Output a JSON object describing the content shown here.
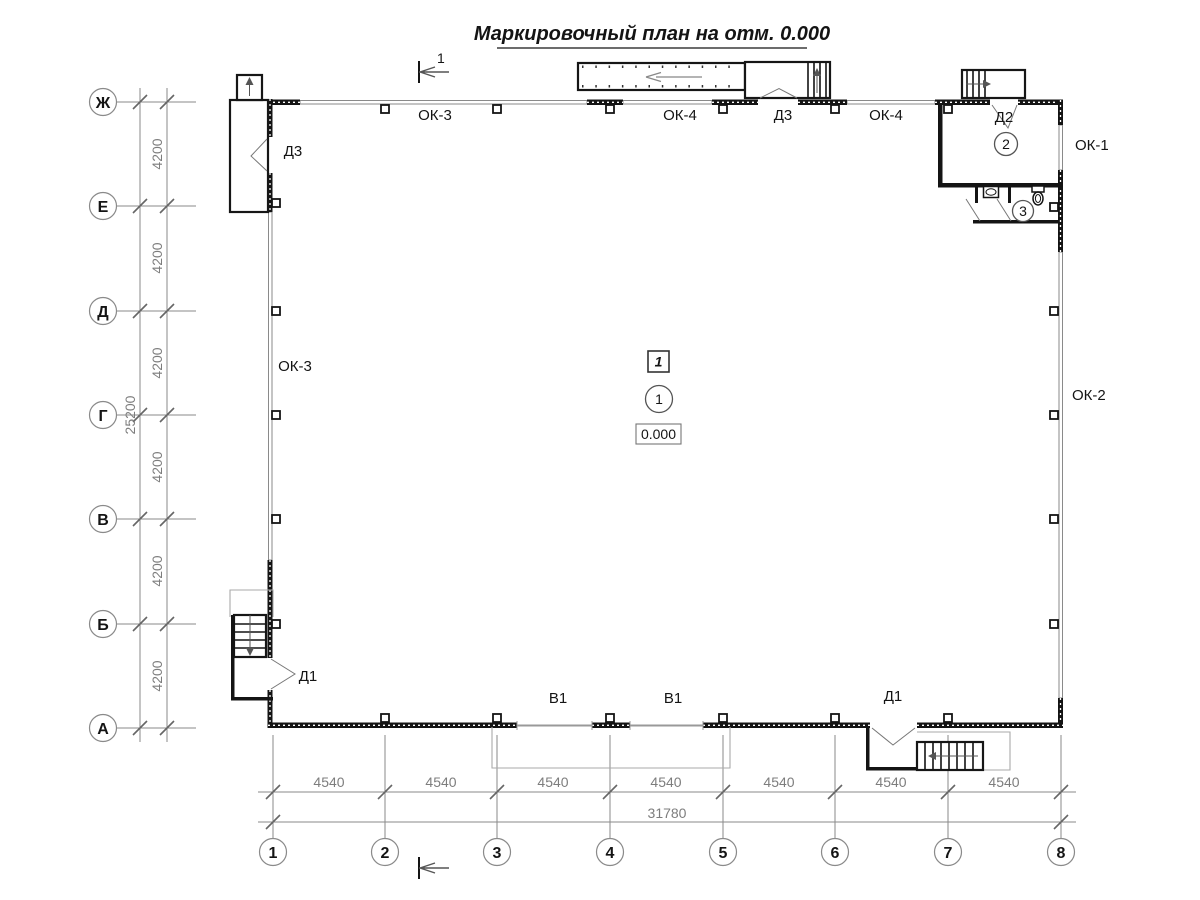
{
  "title": "Маркировочный план на отм. 0.000",
  "axes": {
    "rows": [
      "Ж",
      "Е",
      "Д",
      "Г",
      "В",
      "Б",
      "А"
    ],
    "cols": [
      "1",
      "2",
      "3",
      "4",
      "5",
      "6",
      "7",
      "8"
    ]
  },
  "dims": {
    "v_spans": [
      "4200",
      "4200",
      "4200",
      "4200",
      "4200",
      "4200"
    ],
    "v_total": "25200",
    "h_spans": [
      "4540",
      "4540",
      "4540",
      "4540",
      "4540",
      "4540",
      "4540"
    ],
    "h_total": "31780"
  },
  "labels": {
    "ok3_top": "ОК-3",
    "ok4_top_left": "ОК-4",
    "d3_top": "Д3",
    "ok4_top_right": "ОК-4",
    "d2": "Д2",
    "ok1": "ОК-1",
    "ok2": "ОК-2",
    "ok3_left": "ОК-3",
    "d3_left": "Д3",
    "d1_left": "Д1",
    "d1_right": "Д1",
    "v1_left": "В1",
    "v1_right": "В1"
  },
  "markers": {
    "section": "1",
    "plan_number": "1",
    "room_1": "1",
    "room_2": "2",
    "room_3": "3",
    "elevation": "0.000"
  }
}
